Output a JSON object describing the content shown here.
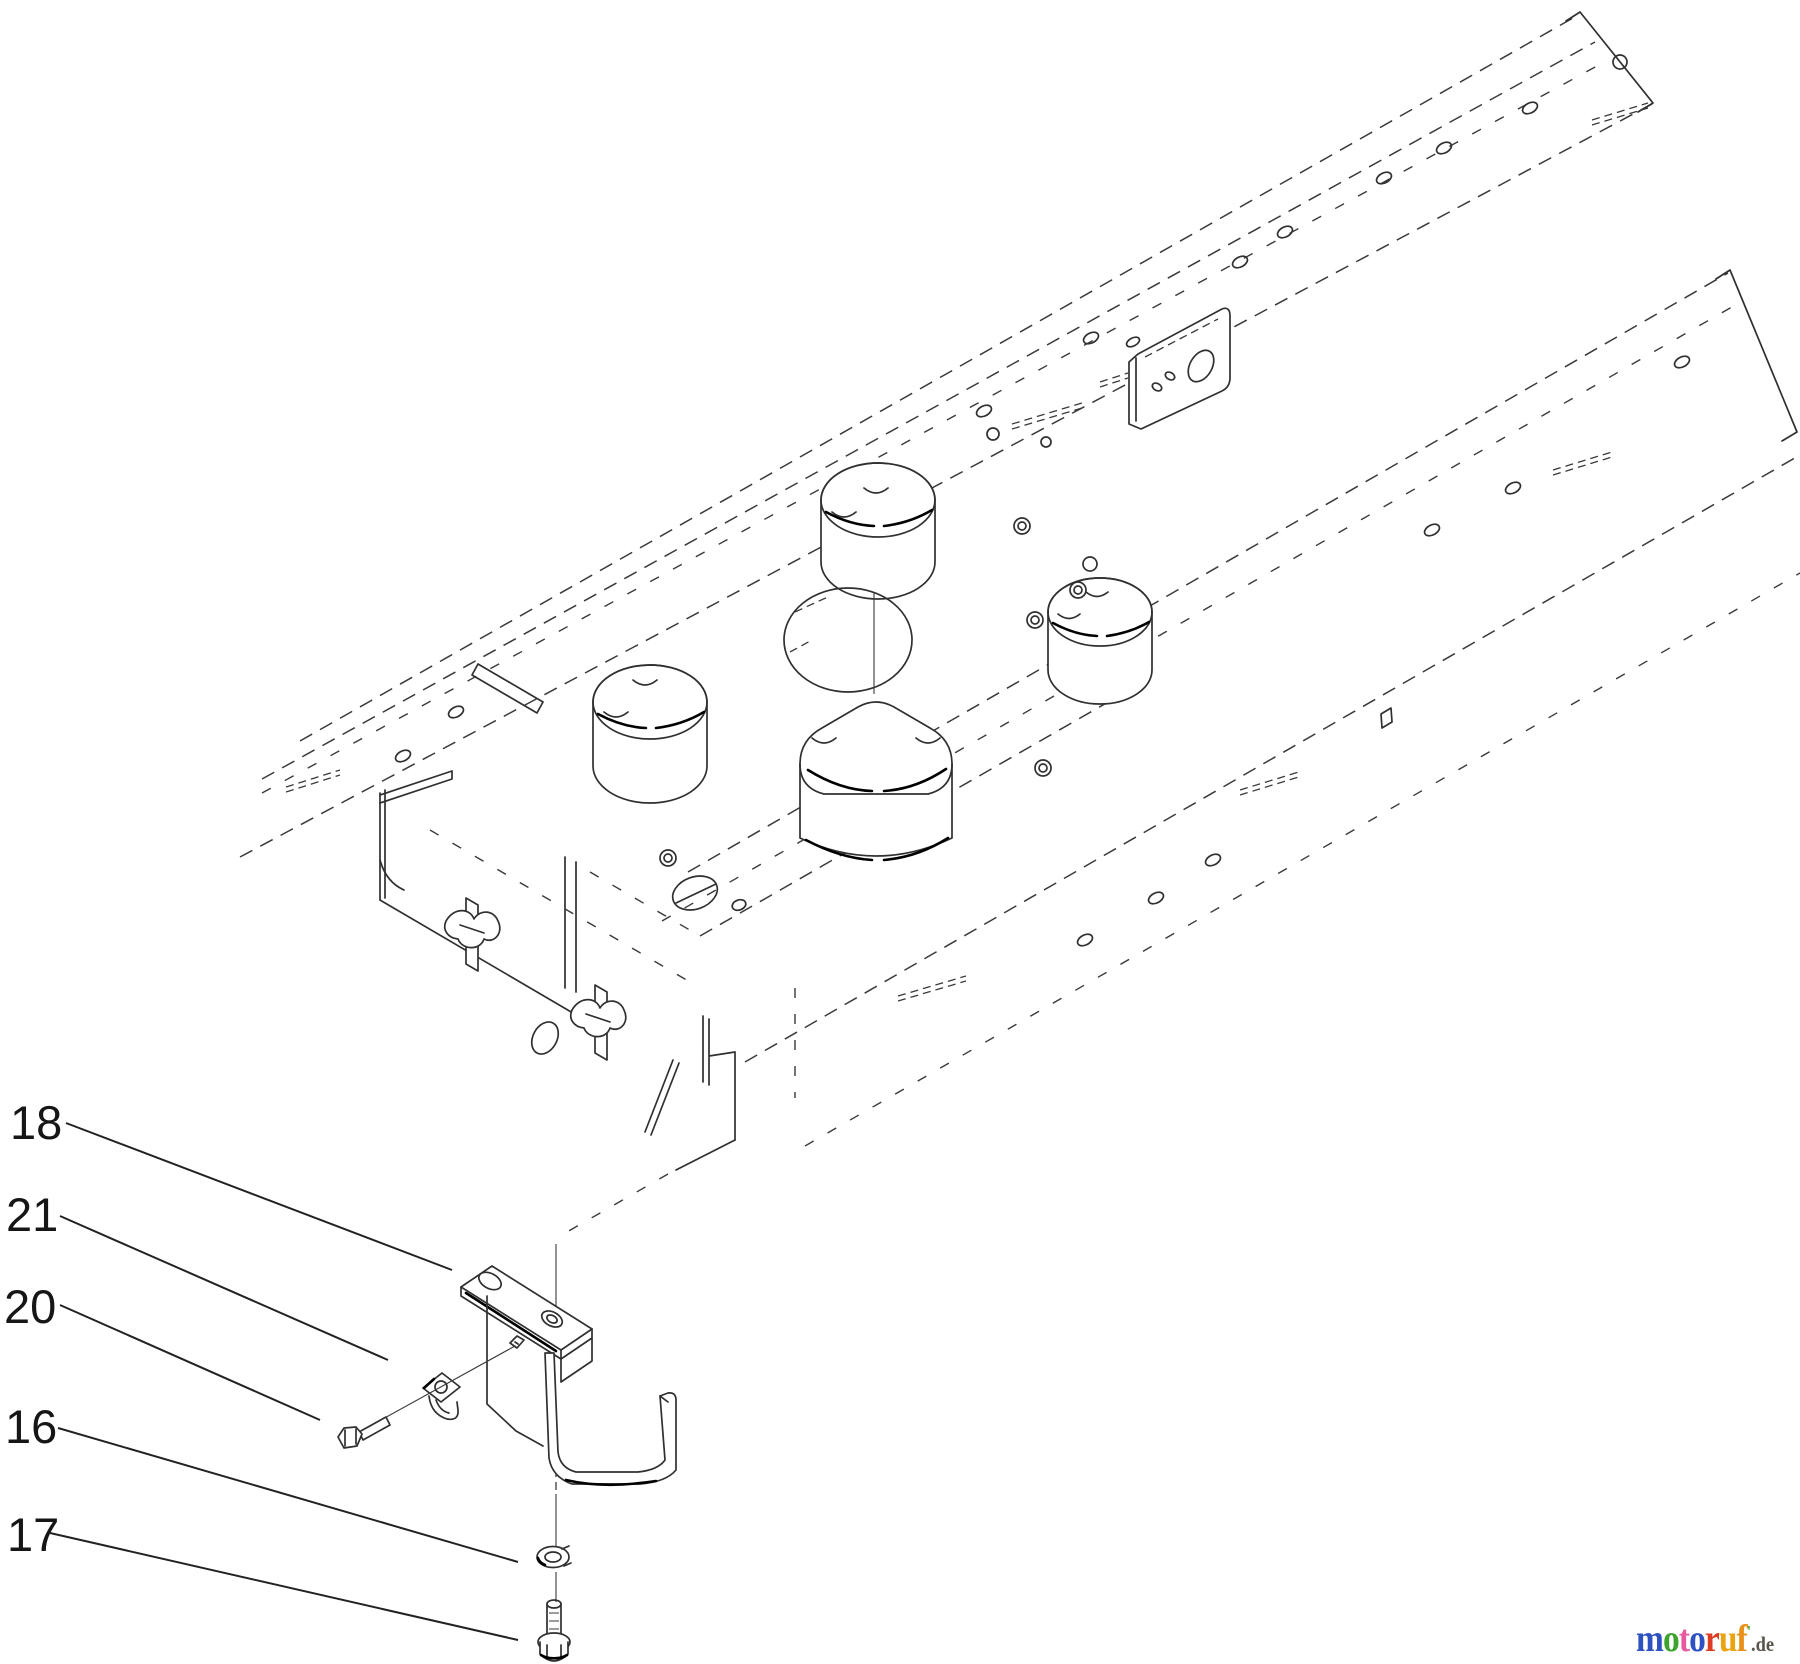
{
  "page": {
    "background": "#ffffff"
  },
  "diagram": {
    "type": "exploded-parts-diagram",
    "line_color": "#303030",
    "callouts": [
      {
        "number": "18",
        "target": "mounting-bracket"
      },
      {
        "number": "21",
        "target": "clip-nut"
      },
      {
        "number": "20",
        "target": "carriage-bolt"
      },
      {
        "number": "16",
        "target": "lock-washer"
      },
      {
        "number": "17",
        "target": "hex-flange-bolt"
      }
    ]
  },
  "watermark": {
    "word": "motoruf",
    "letters": [
      {
        "char": "m",
        "color": "#2f52c3"
      },
      {
        "char": "o",
        "color": "#3ca32c"
      },
      {
        "char": "t",
        "color": "#e85aa0"
      },
      {
        "char": "o",
        "color": "#2f52c3"
      },
      {
        "char": "r",
        "color": "#df3d23"
      },
      {
        "char": "u",
        "color": "#eaa411"
      },
      {
        "char": "f",
        "color": "#e8901a"
      }
    ],
    "mark": {
      "char": "'",
      "color": "#3ca32c"
    },
    "tld": {
      "text": ".de",
      "color": "#5a544c"
    }
  }
}
